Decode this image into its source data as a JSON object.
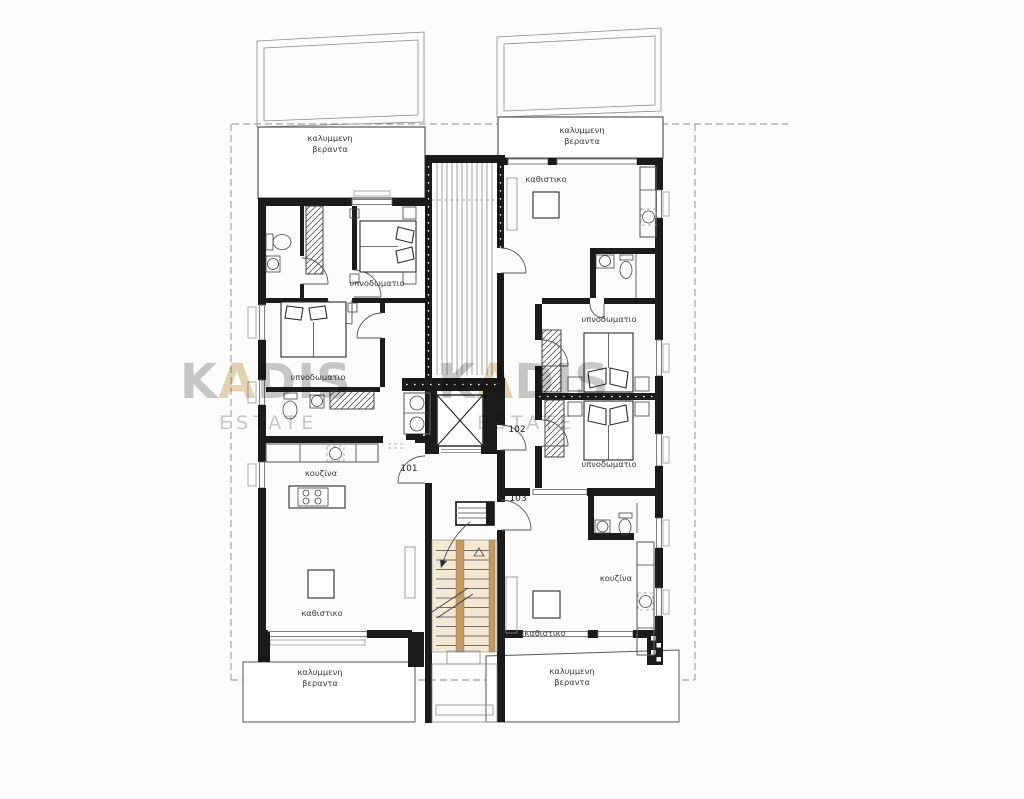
{
  "plan": {
    "type": "apartment floor plan",
    "language": "Greek"
  },
  "labels": {
    "covered_veranda_line1": "καλυμμενη",
    "covered_veranda_line2": "βεραντα",
    "bedroom": "υπνοδωματιο",
    "living_room": "καθιστικο",
    "kitchen": "κουζίνα"
  },
  "units": {
    "u101": {
      "number": "101"
    },
    "u102": {
      "number": "102"
    },
    "u103": {
      "number": "103"
    }
  },
  "watermark": {
    "brand_full": "KADIS",
    "brand_prefix": "K",
    "accent_letter": "A",
    "brand_suffix": "DIS",
    "subtitle": "ESTATE"
  },
  "colors": {
    "wall": "#1b1b1b",
    "stair-fill": "#f2e9d4",
    "stair-wood": "#c49a62",
    "watermark-gray": "#7d7d7d",
    "watermark-gold": "#c49a4e",
    "paper": "#fcfcfb"
  }
}
